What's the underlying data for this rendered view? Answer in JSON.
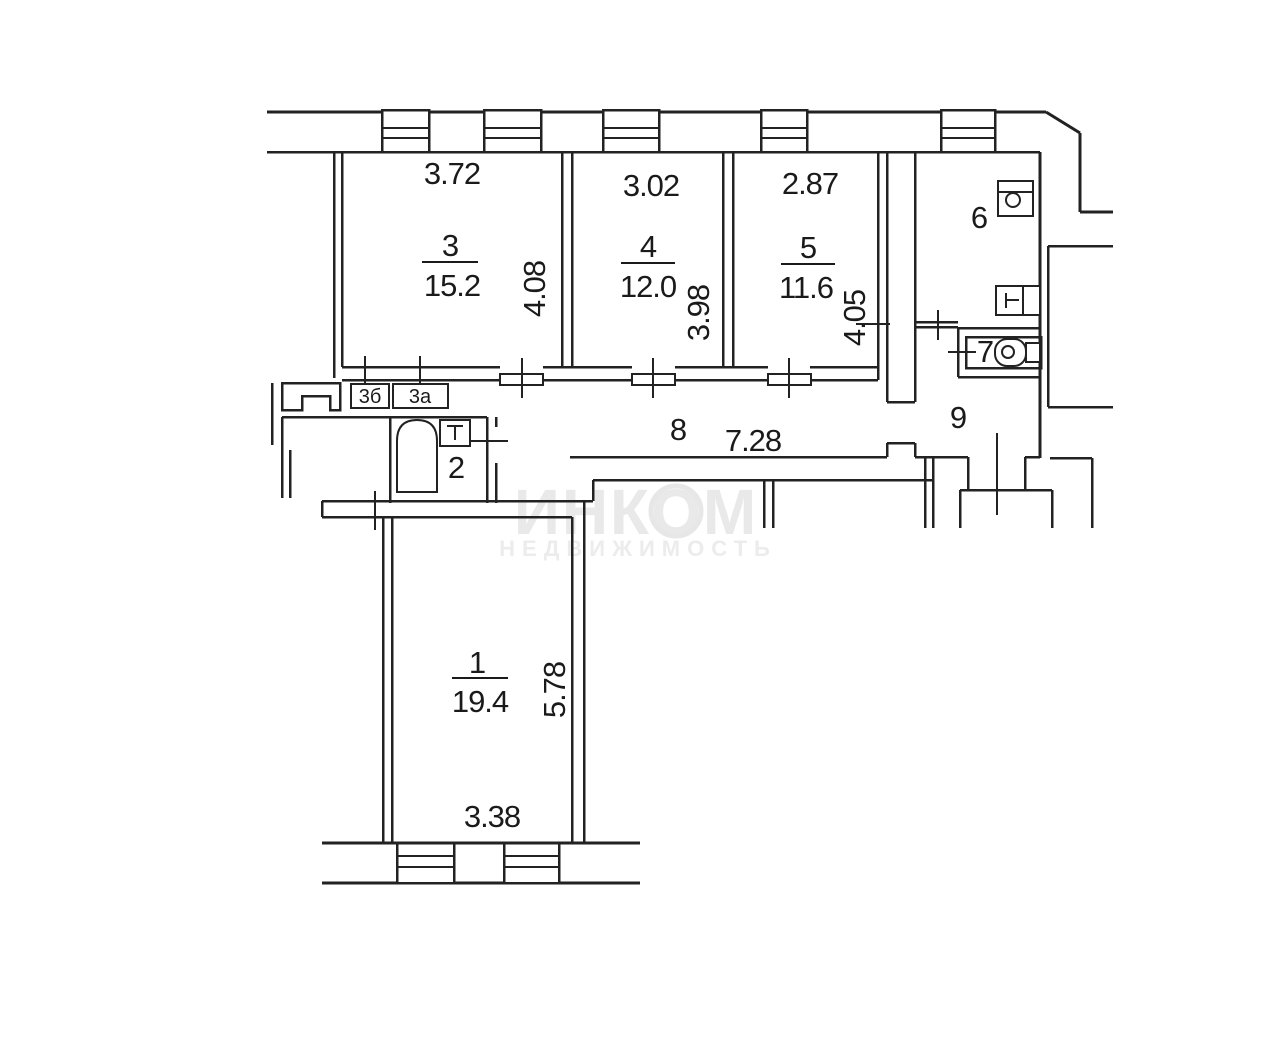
{
  "watermark": {
    "brand": "ИНКОМ",
    "subtitle": "НЕДВИЖИМОСТЬ"
  },
  "rooms": {
    "r1": {
      "number": "1",
      "area": "19.4",
      "width_m": "3.38",
      "depth_m": "5.78"
    },
    "r2": {
      "number": "2"
    },
    "r3": {
      "number": "3",
      "area": "15.2",
      "width_m": "3.72",
      "depth_m": "4.08"
    },
    "r3a": {
      "number": "3а"
    },
    "r3b": {
      "number": "3б"
    },
    "r4": {
      "number": "4",
      "area": "12.0",
      "width_m": "3.02",
      "depth_m": "3.98"
    },
    "r5": {
      "number": "5",
      "area": "11.6",
      "width_m": "2.87",
      "depth_m": "4.05"
    },
    "r6": {
      "number": "6"
    },
    "r7": {
      "number": "7"
    },
    "r8": {
      "number": "8",
      "length_m": "7.28"
    },
    "r9": {
      "number": "9"
    }
  },
  "colors": {
    "line": "#222222",
    "watermark": "#e9e9e9",
    "background": "#ffffff"
  }
}
